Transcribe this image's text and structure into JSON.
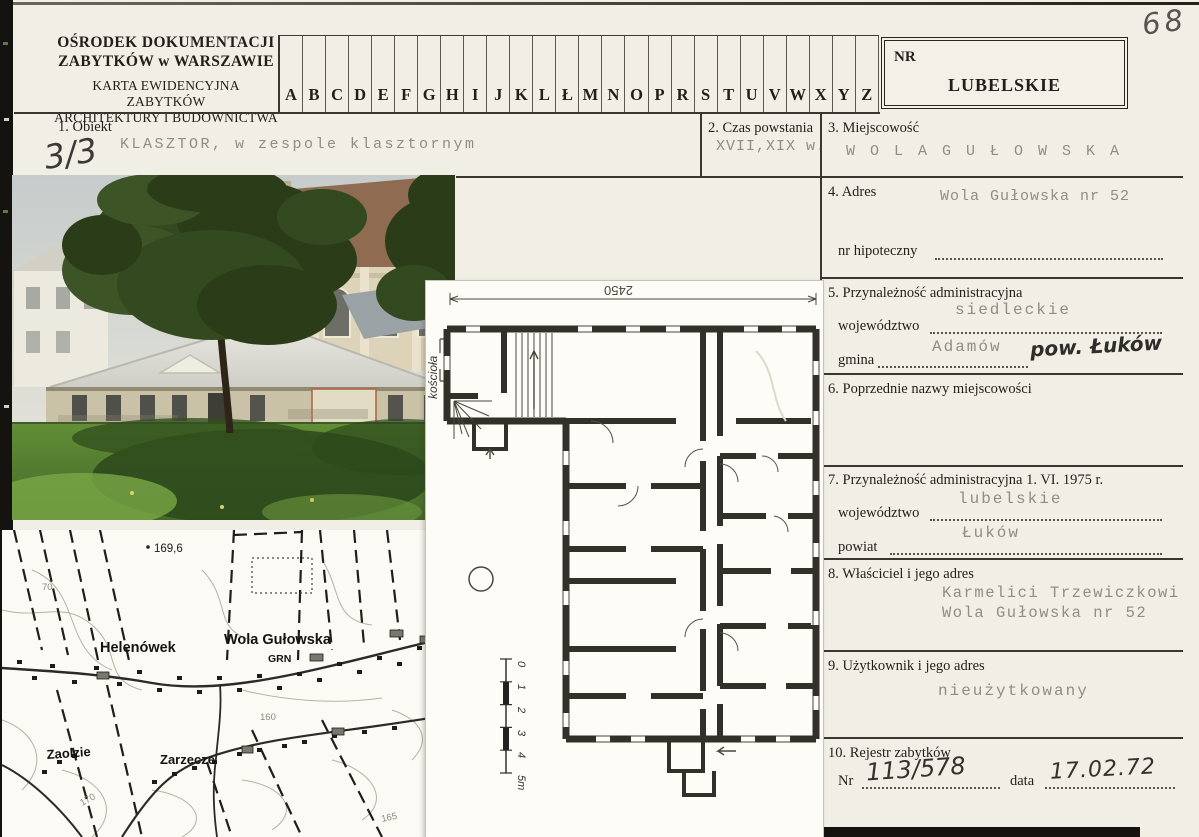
{
  "scan": {
    "page_note": "68",
    "copy_note": "3/3"
  },
  "header": {
    "institution_line1": "OŚRODEK DOKUMENTACJI",
    "institution_line2": "ZABYTKÓW w WARSZAWIE",
    "card_line1": "KARTA EWIDENCYJNA ZABYTKÓW",
    "card_line2": "ARCHITEKTURY I BUDOWNICTWA",
    "alphabet": [
      "A",
      "B",
      "C",
      "D",
      "E",
      "F",
      "G",
      "H",
      "I",
      "J",
      "K",
      "L",
      "Ł",
      "M",
      "N",
      "O",
      "P",
      "R",
      "S",
      "T",
      "U",
      "V",
      "W",
      "X",
      "Y",
      "Z"
    ],
    "nr_label": "NR",
    "region": "LUBELSKIE"
  },
  "fields": {
    "obiekt": {
      "label": "1. Obiekt",
      "value": "KLASZTOR, w zespole klasztornym"
    },
    "czas": {
      "label": "2. Czas powstania",
      "value": "XVII,XIX w."
    },
    "miejscowosc": {
      "label": "3. Miejscowość",
      "value": "W O L A   G U Ł O W S K A"
    },
    "adres": {
      "label": "4. Adres",
      "value": "Wola Gułowska nr 52",
      "hipoteczny_label": "nr hipoteczny"
    },
    "przynaleznosc": {
      "label": "5. Przynależność administracyjna",
      "wojewodztwo_label": "województwo",
      "wojewodztwo": "siedleckie",
      "gmina_label": "gmina",
      "gmina": "Adamów",
      "gmina_note": "pow. Łuków"
    },
    "poprzednie": {
      "label": "6. Poprzednie nazwy miejscowości"
    },
    "przynaleznosc1975": {
      "label": "7. Przynależność administracyjna 1. VI. 1975 r.",
      "wojewodztwo_label": "województwo",
      "wojewodztwo": "lubelskie",
      "powiat_label": "powiat",
      "powiat": "Łuków"
    },
    "wlasciciel": {
      "label": "8. Właściciel i jego adres",
      "line1": "Karmelici Trzewiczkowi",
      "line2": "Wola Gułowska nr 52"
    },
    "uzytkownik": {
      "label": "9. Użytkownik i jego adres",
      "value": "nieużytkowany"
    },
    "rejestr": {
      "label": "10. Rejestr zabytków",
      "nr_label": "Nr",
      "nr": "113/578",
      "data_label": "data",
      "data": "17.02.72"
    }
  },
  "map": {
    "places": {
      "helenowek": "Helenówek",
      "wola": "Wola Gułowska",
      "grn": "GRN",
      "zaolzie": "Zaolzie",
      "zarzecze": "Zarzecze"
    },
    "elevations": {
      "spot": "169,6",
      "c70": "70",
      "c160": "160",
      "c165": "165",
      "c170": "170"
    }
  },
  "plan": {
    "dimension": "2450",
    "side_note": "kościoła",
    "scale_labels": [
      "0",
      "1",
      "2",
      "3",
      "4",
      "5m"
    ]
  }
}
